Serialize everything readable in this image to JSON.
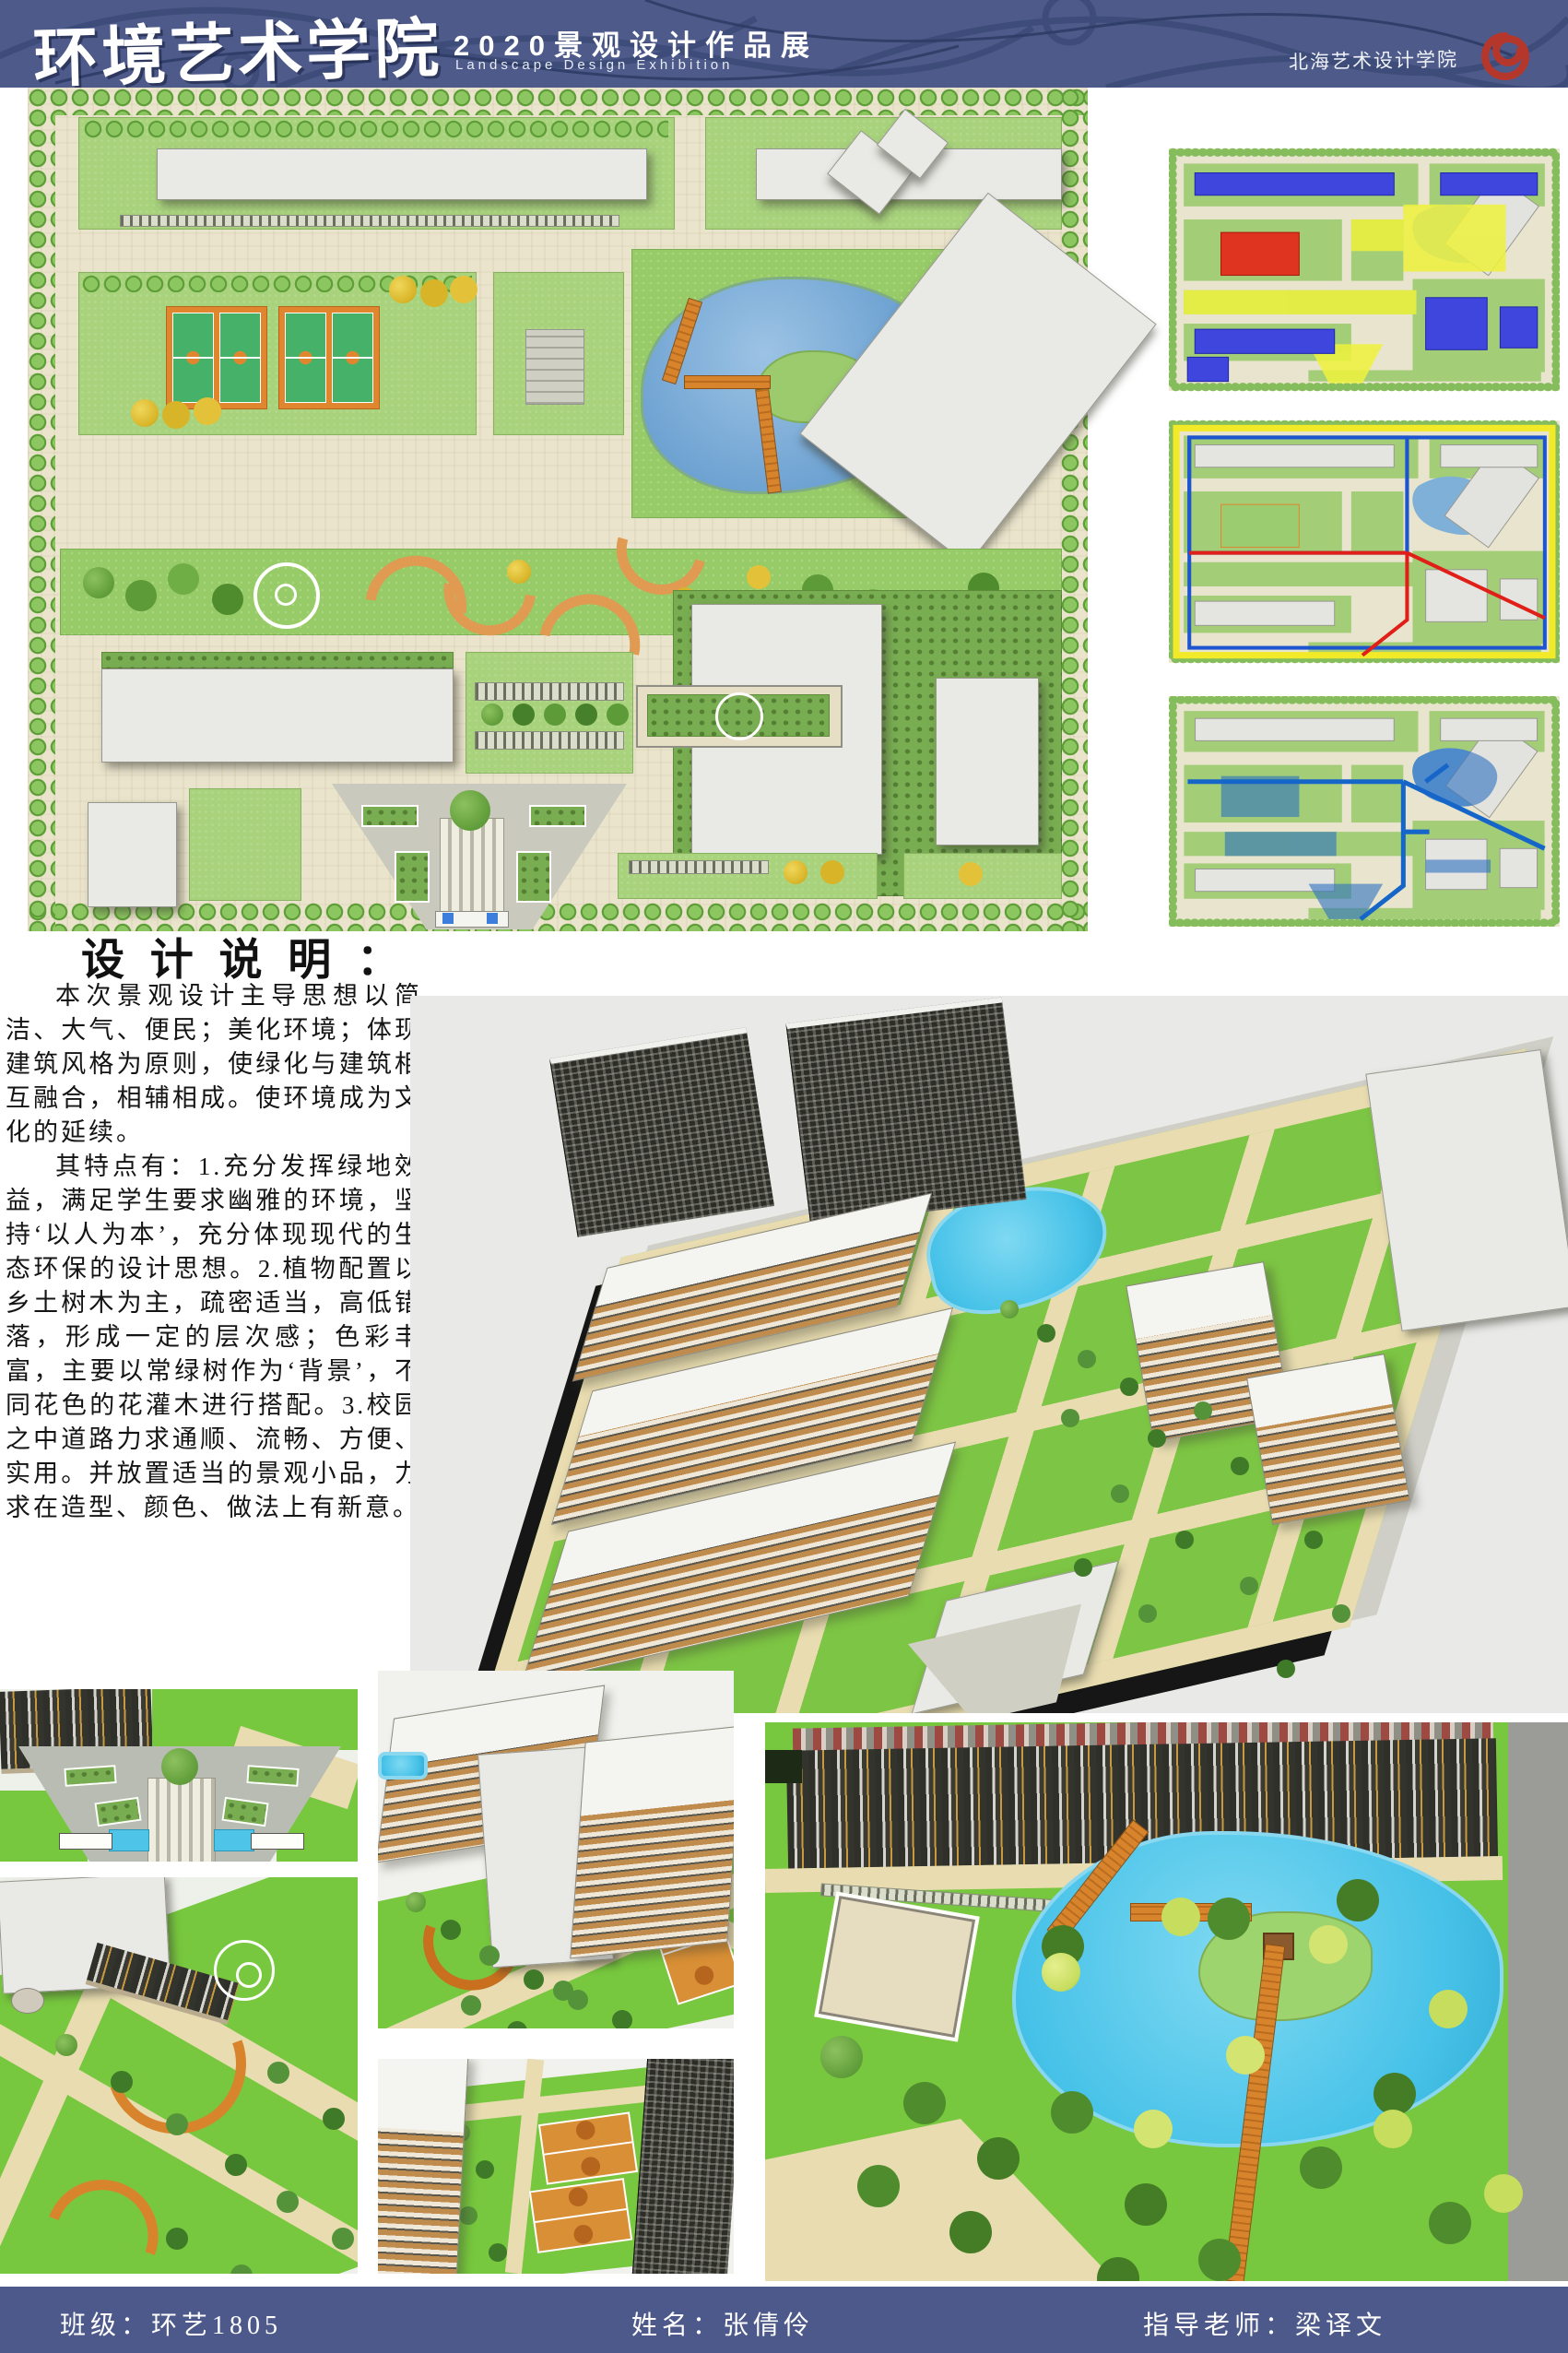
{
  "header": {
    "school_title": "环境艺术学院",
    "exhibition_title": "2020景观设计作品展",
    "exhibition_subtitle": "Landscape Design Exhibition",
    "institute_name": "北海艺术设计学院",
    "colors": {
      "band": "#4e5b8a",
      "pattern": "#3b4a77",
      "logo_red": "#b5372c",
      "text": "#ffffff"
    }
  },
  "design_statement": {
    "title": "设 计 说 明 ：",
    "paragraph_1": "本次景观设计主导思想以简洁、大气、便民；美化环境；体现建筑风格为原则，使绿化与建筑相互融合，相辅相成。使环境成为文化的延续。",
    "paragraph_2": "其特点有：1.充分发挥绿地效益，满足学生要求幽雅的环境，坚持‘以人为本’，充分体现现代的生态环保的设计思想。2.植物配置以乡土树木为主，疏密适当，高低错落，形成一定的层次感；色彩丰富，主要以常绿树作为‘背景’，不同花色的花灌木进行搭配。3.校园之中道路力求通顺、流畅、方便、实用。并放置适当的景观小品，力求在造型、颜色、做法上有新意。"
  },
  "footer": {
    "class_label": "班级：环艺1805",
    "name_label": "姓名：张倩伶",
    "advisor_label": "指导老师：梁译文",
    "color": "#4d598a"
  },
  "plan_colors": {
    "paving": "#eae4cd",
    "lawn": "#a8d37c",
    "hedge": "#79ad52",
    "tree_border": "#8cc660",
    "building": "#e9e9e5",
    "pond": "#6fa3d2",
    "court_green": "#46b169",
    "court_orange": "#e0862e",
    "deck_orange": "#e09a52",
    "zoning_blue": "#3f46dd",
    "zoning_red": "#de3420",
    "zoning_yellow": "#eef23c",
    "analysis_blue": "#1d55d0",
    "analysis_red": "#e02018",
    "water_axis_blue": "#1566c8"
  },
  "render_colors": {
    "backdrop": "#e9e9e7",
    "lawn": "#7dc544",
    "path": "#e8dcb0",
    "wood_facade": "#c08c4e",
    "dark_building": "#2d2d28",
    "water": "#47c2e8",
    "boardwalk": "#d8842c",
    "base": "#161616"
  }
}
